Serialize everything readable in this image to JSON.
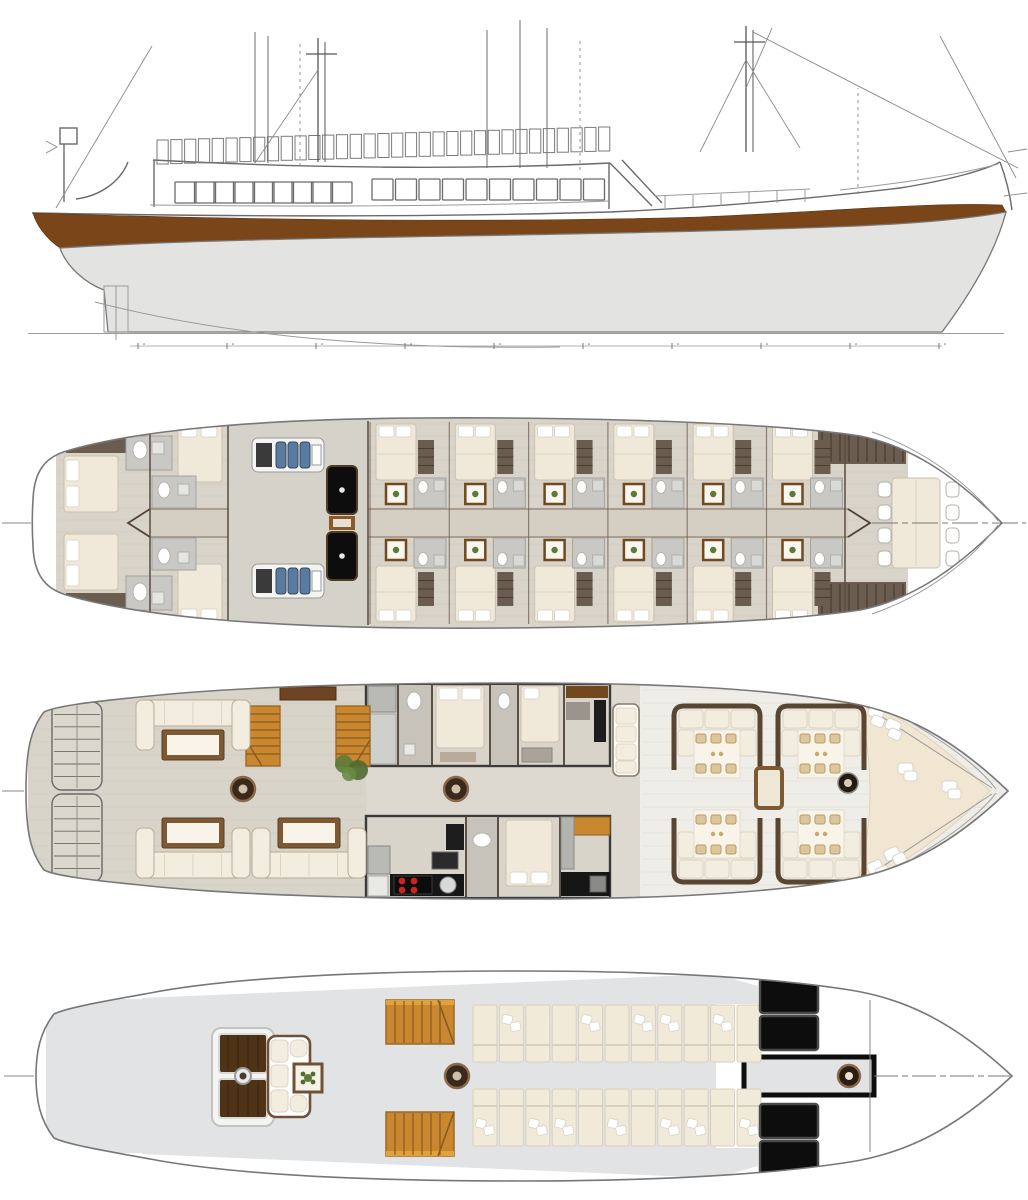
{
  "meta": {
    "drawing": "sailing-yacht-general-arrangement-plans",
    "views": [
      {
        "id": "side-elevation",
        "label": "side elevation profile"
      },
      {
        "id": "lower-deck",
        "label": "lower deck - guest cabins and engine room"
      },
      {
        "id": "main-deck",
        "label": "main deck - aft lounge, cabins, galley, fore dining"
      },
      {
        "id": "sun-deck",
        "label": "sun deck - lounge and sunbeds"
      }
    ]
  },
  "colors": {
    "paper": "#ffffff",
    "line": "#6a6a6a",
    "stripe": "#7a4519",
    "underwater": "#e3e4e2",
    "floor": "#d9d4ca",
    "floor_light": "#efede8",
    "corridor": "#d5cfc3",
    "wall": "#57473c",
    "bed": "#f0e9d9",
    "pillow": "#ffffff",
    "bath": "#c9c8c4",
    "slat": "#6b5c50",
    "wood": "#c9882f",
    "wood_dark": "#72491f",
    "sofa": "#f3eddf",
    "table_top": "#f8f4ea",
    "table_trim": "#7d5a33",
    "black": "#0d0d0d",
    "steel": "#b9b9b6",
    "engine": "#5a7ba0",
    "burner": "#cc2222",
    "green": "#5d7a3a",
    "sundeck": "#e2e3e4",
    "sunbed": "#f1ead9",
    "pad": "#f0e6d2",
    "rim": "#5a4630",
    "setting": "#dcc69e"
  },
  "profile": {
    "railing": {
      "x": 157,
      "count": 33,
      "pitch": 13.8,
      "h": 24,
      "y_start": 140,
      "y_end": 127
    },
    "windows": {
      "size": 21,
      "groups": [
        {
          "x": 175,
          "count": 9,
          "pitch": 19.5,
          "y": 182
        },
        {
          "x": 372,
          "count": 10,
          "pitch": 23.5,
          "y": 179
        }
      ]
    },
    "masts": [
      {
        "x": 318,
        "deck": 162,
        "top": 38,
        "gap": 7
      },
      {
        "x": 746,
        "deck": 152,
        "top": 26,
        "gap": 7
      }
    ],
    "aux_masts": [
      {
        "x": 255,
        "deck": 163,
        "top": 32
      },
      {
        "x": 268,
        "deck": 163,
        "top": 36
      },
      {
        "x": 487,
        "deck": 168,
        "top": 30
      },
      {
        "x": 520,
        "deck": 168,
        "top": 20
      },
      {
        "x": 547,
        "deck": 168,
        "top": 28
      }
    ],
    "dashed_verticals": [
      {
        "x": 300,
        "deck": 166,
        "top": 44
      },
      {
        "x": 580,
        "deck": 170,
        "top": 40
      },
      {
        "x": 858,
        "deck": 194,
        "top": 88
      }
    ],
    "stays": [
      [
        152,
        46,
        56,
        208
      ],
      [
        940,
        36,
        1016,
        178
      ],
      [
        753,
        32,
        1018,
        168
      ],
      [
        746,
        88,
        772,
        28
      ],
      [
        318,
        70,
        255,
        163
      ],
      [
        746,
        60,
        700,
        152
      ],
      [
        746,
        60,
        800,
        148
      ],
      [
        1008,
        152,
        1027,
        149
      ],
      [
        1004,
        196,
        1027,
        193
      ]
    ],
    "baseline_ticks": {
      "x": 138,
      "count": 10,
      "pitch": 89,
      "y": 346
    }
  },
  "lower_deck": {
    "bulkheads": [
      150,
      228,
      368,
      845
    ],
    "guest_cabins": {
      "x": 370,
      "count": 6,
      "pitch": 79.3,
      "sides": 2
    },
    "aft_cabins": 2,
    "mid_cabins": 2,
    "engine_room": {
      "engines": [
        {
          "x": 252,
          "y": 438
        },
        {
          "x": 252,
          "y": 564
        }
      ],
      "tanks": [
        {
          "x": 327,
          "y": 466
        },
        {
          "x": 327,
          "y": 532
        }
      ]
    },
    "crew": {
      "chair_rows": 4,
      "chair_cols_x": [
        878,
        946
      ],
      "chair_y": 482,
      "chair_pitch": 23
    }
  },
  "main_deck": {
    "stern_benches": [
      {
        "x": 52,
        "y": 702
      },
      {
        "x": 52,
        "y": 794
      }
    ],
    "lounges": [
      {
        "x": 136,
        "y": 700,
        "dir": 1
      },
      {
        "x": 136,
        "y": 878,
        "dir": -1
      },
      {
        "x": 252,
        "y": 878,
        "dir": -1
      }
    ],
    "mast_bases": [
      {
        "cx": 243,
        "cy": 789
      },
      {
        "cx": 456,
        "cy": 789
      }
    ],
    "booths": [
      {
        "x": 672,
        "y": 704,
        "flip": false
      },
      {
        "x": 776,
        "y": 704,
        "flip": false
      },
      {
        "x": 672,
        "y": 810,
        "flip": true
      },
      {
        "x": 776,
        "y": 810,
        "flip": true
      }
    ],
    "settings_per_table": 6,
    "bow_cushions": [
      {
        "x": 876,
        "y": 714,
        "r": 24
      },
      {
        "x": 893,
        "y": 727,
        "r": 24
      },
      {
        "x": 906,
        "y": 770,
        "r": 0
      },
      {
        "x": 950,
        "y": 788,
        "r": 0
      },
      {
        "x": 893,
        "y": 855,
        "r": -24
      },
      {
        "x": 876,
        "y": 868,
        "r": -24
      }
    ],
    "windlass": {
      "cx": 848,
      "cy": 783
    },
    "hatch": {
      "x": 756,
      "y": 768,
      "w": 26,
      "h": 40
    }
  },
  "sun_deck": {
    "sunbeds": {
      "x": 473,
      "pitch": 26.4,
      "w": 24,
      "h": 57,
      "count_per_row": 11,
      "rows": [
        {
          "y": 1005,
          "split": 40,
          "pillows": [
            1,
            4,
            6,
            7,
            9
          ]
        },
        {
          "y": 1089,
          "split": 17,
          "pillows": [
            0,
            2,
            3,
            5,
            7,
            8,
            10
          ]
        }
      ]
    },
    "solar_panels": [
      {
        "x": 760,
        "y": 979
      },
      {
        "x": 760,
        "y": 1016
      },
      {
        "x": 760,
        "y": 1104
      },
      {
        "x": 760,
        "y": 1141
      }
    ],
    "stairs": [
      {
        "x": 386,
        "y": 1000,
        "d": 1
      },
      {
        "x": 386,
        "y": 1112,
        "d": -1
      }
    ],
    "mast_base": {
      "cx": 457,
      "cy": 1076
    },
    "windlass": {
      "cx": 849,
      "cy": 1076
    }
  }
}
